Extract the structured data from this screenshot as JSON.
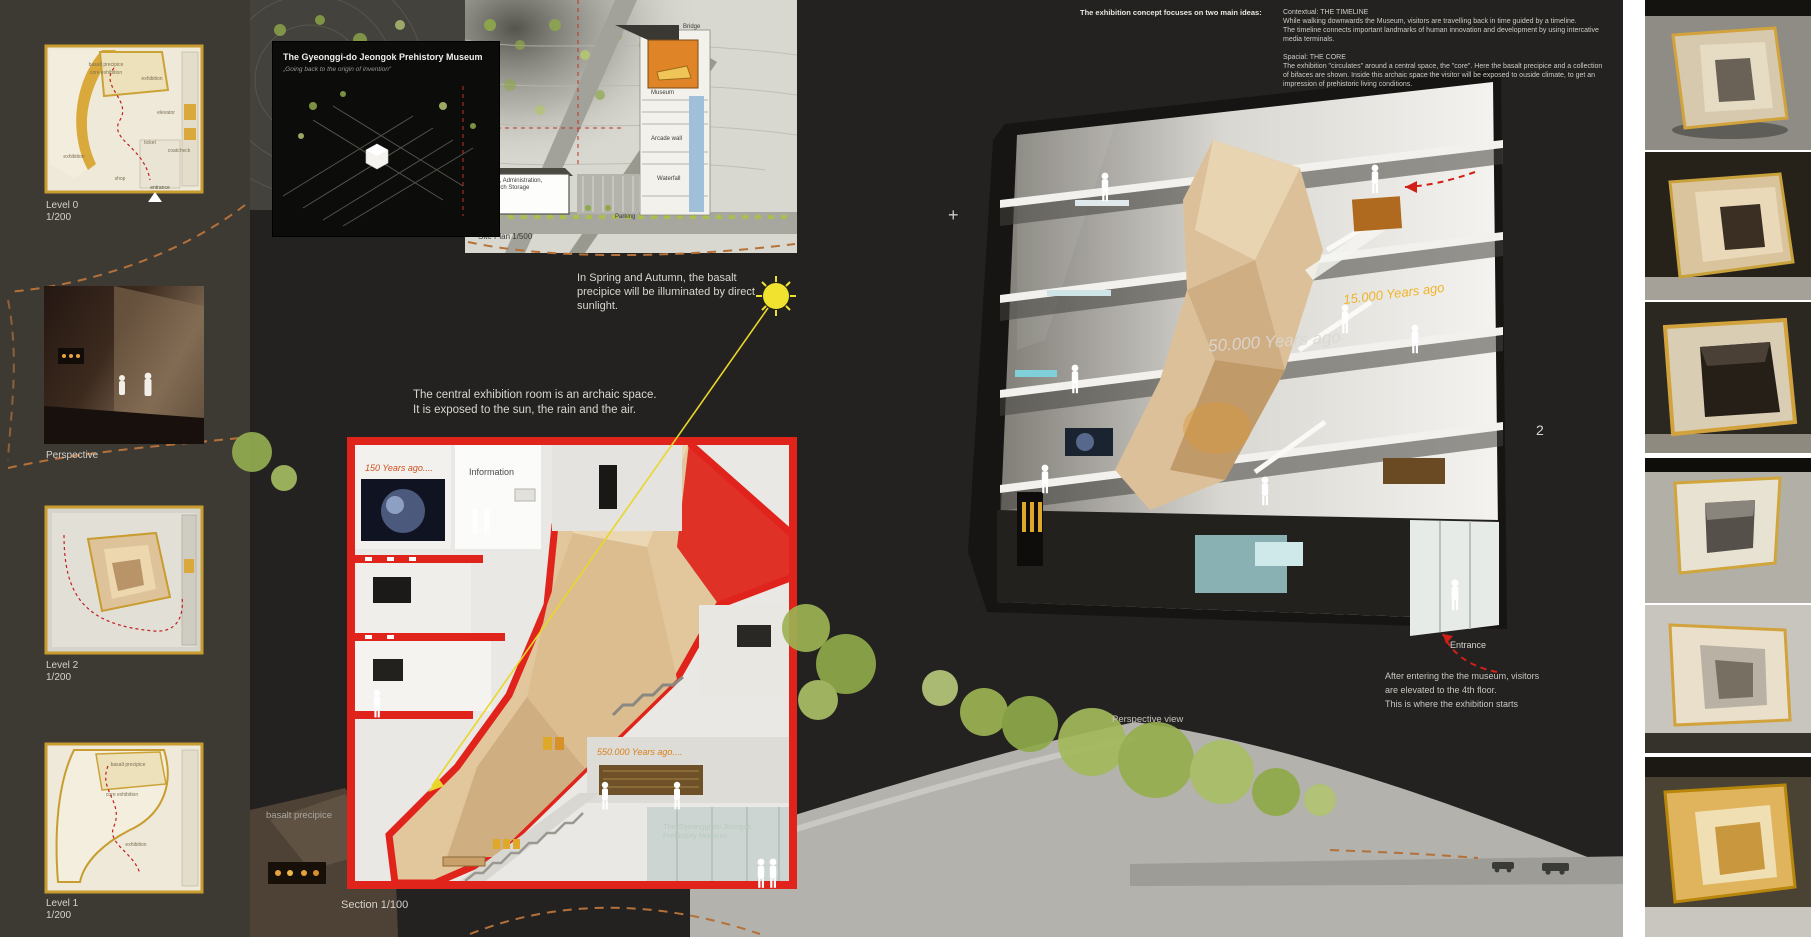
{
  "sidebar": {
    "items": [
      {
        "line1": "Level 0",
        "line2": "1/200"
      },
      {
        "line1": "Perspective",
        "line2": ""
      },
      {
        "line1": "Level 2",
        "line2": "1/200"
      },
      {
        "line1": "Level 1",
        "line2": "1/200"
      }
    ],
    "level0_labels": {
      "basalt": "basalt precipice",
      "core": "core exhibition",
      "exhibition_a": "exhibition",
      "exhibition_b": "exhibition",
      "elevator": "elevator",
      "ticket": "ticket",
      "coatcheck": "coatcheck",
      "shop": "shop",
      "entrance": "entrance"
    },
    "level1_labels": {
      "basalt": "basalt precipice",
      "core": "core exhibition",
      "exhibition": "exhibition"
    }
  },
  "title_panel": {
    "title": "The Gyeonggi-do Jeongok Prehistory Museum",
    "subtitle": "„Going back to the origin of invention“"
  },
  "site_plan": {
    "bridge": "Bridge",
    "museum": "Museum",
    "arcade_wall": "Arcade wall",
    "waterfall": "Waterfall",
    "offices": "Offices, Administration, Research Storage",
    "parking": "Parking",
    "caption": "Site Plan 1/500"
  },
  "notes": {
    "sun": "In Spring and Autumn, the basalt precipice will be illuminated by direct sunlight.",
    "core_line1": "The central exhibition room is an archaic space.",
    "core_line2": "It is exposed to the sun, the rain and the air."
  },
  "section": {
    "label_150": "150 Years ago....",
    "label_info": "Information",
    "label_550000": "550.000 Years ago....",
    "label_basalt": "basalt precipice",
    "glass_title_line1": "The Gyeonggi-do Jeongok",
    "glass_title_line2": "Prehistory Museum",
    "caption": "Section 1/100"
  },
  "concept": {
    "heading": "The exhibition concept focuses on two main ideas:",
    "contextual_title": "Contextual: THE TIMELINE",
    "contextual_lines": [
      "While walking downwards the Museum, visitors are travelling back in time guided by a timeline.",
      "The timeline connects important landmarks of human innovation and development by using intercative",
      "media terminals."
    ],
    "spacial_title": "Spacial: THE CORE",
    "spacial_lines": [
      "The exhibition \"circulates\" around a central space, the \"core\". Here the basalt precipice and a collection",
      "of bifaces are shown. Inside this archaic space the visitor will be exposed to ouside climate, to get an",
      "impression of prehistoric living conditions."
    ]
  },
  "perspective": {
    "label_50000": "50.000 Years ago",
    "label_15000": "15.000 Years ago",
    "entrance": "Entrance",
    "caption": "Perspective view",
    "page_number": "2",
    "plus_marker": "+",
    "note_lines": [
      "After entering the the museum, visitors",
      "are elevated to the 4th floor.",
      "This is where the exhibition starts"
    ]
  },
  "colors": {
    "accent_red": "#e0241c",
    "accent_gold": "#d2a23c",
    "accent_orange": "#e08428",
    "tree_green": "#9cb553",
    "sun_yellow": "#f0e22e"
  }
}
